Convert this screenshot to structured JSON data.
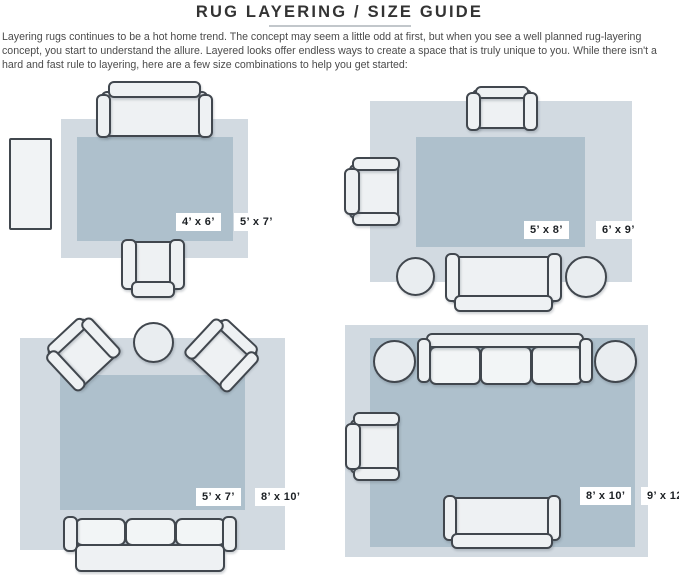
{
  "header": {
    "title": "RUG LAYERING / SIZE GUIDE"
  },
  "intro": "Layering rugs continues to be a hot home trend. The concept may seem a little odd at first, but when you see a well planned rug-layering concept, you start to understand the allure. Layered looks offer endless ways to create a space that is truly unique to you. While there isn't a hard and fast rule to layering, here are a few size combinations to help you get started:",
  "colors": {
    "outer_rug": "#d2dae1",
    "inner_rug": "#aec0cc",
    "furniture": "#eef1f3",
    "outline": "#41474e"
  },
  "layouts": [
    {
      "name": "top-left",
      "inner_rug_size": "4’ x 6’",
      "outer_rug_size": "5’ x 7’"
    },
    {
      "name": "top-right",
      "inner_rug_size": "5’ x 8’",
      "outer_rug_size": "6’ x 9’"
    },
    {
      "name": "bottom-left",
      "inner_rug_size": "5’ x 7’",
      "outer_rug_size": "8’ x 10’"
    },
    {
      "name": "bottom-right",
      "inner_rug_size": "8’ x 10’",
      "outer_rug_size": "9’ x 12’"
    }
  ]
}
